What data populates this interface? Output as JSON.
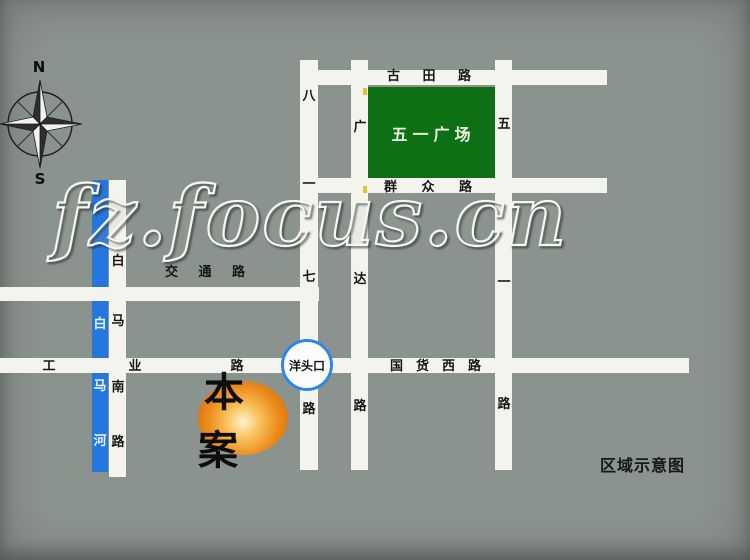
{
  "caption": "区域示意图",
  "compass": {
    "n": "N",
    "s": "S"
  },
  "watermark": {
    "text": "fz.focus.cn"
  },
  "landmarks": {
    "square": "五一广场",
    "site": "本案",
    "junction": "洋头口"
  },
  "roads": {
    "gutian": {
      "name": "古田路",
      "c": [
        "古",
        "田",
        "路"
      ]
    },
    "qunzhong": {
      "name": "群众路",
      "c": [
        "群",
        "众",
        "路"
      ]
    },
    "jiaotong": {
      "name": "交通路",
      "c": [
        "交",
        "通",
        "路"
      ]
    },
    "gongye": {
      "name": "工业路",
      "c": [
        "工",
        "业",
        "路"
      ]
    },
    "guohuoxi": {
      "name": "国货西路",
      "c": [
        "国",
        "货",
        "西",
        "路"
      ]
    },
    "bayiqi": {
      "name": "八一七路",
      "c": [
        "八",
        "一",
        "七",
        "路"
      ]
    },
    "guangda": {
      "name": "广达路",
      "c": [
        "广",
        "达",
        "路"
      ]
    },
    "wuyi": {
      "name": "五一路",
      "c": [
        "五",
        "一",
        "路"
      ]
    },
    "baimanan": {
      "name": "白马南路",
      "c": [
        "白",
        "马",
        "南",
        "路"
      ]
    },
    "baimahe": {
      "name": "白马河",
      "c": [
        "白",
        "马",
        "河"
      ]
    }
  },
  "colors": {
    "background": "#8b938e",
    "road_white": "#f3f4ee",
    "square_green": "#0e7014",
    "river_blue": "#2478dd",
    "junction_ring_blue": "#2f86e8",
    "site_orange": "#ec8c1c",
    "label_text": "#161616"
  }
}
